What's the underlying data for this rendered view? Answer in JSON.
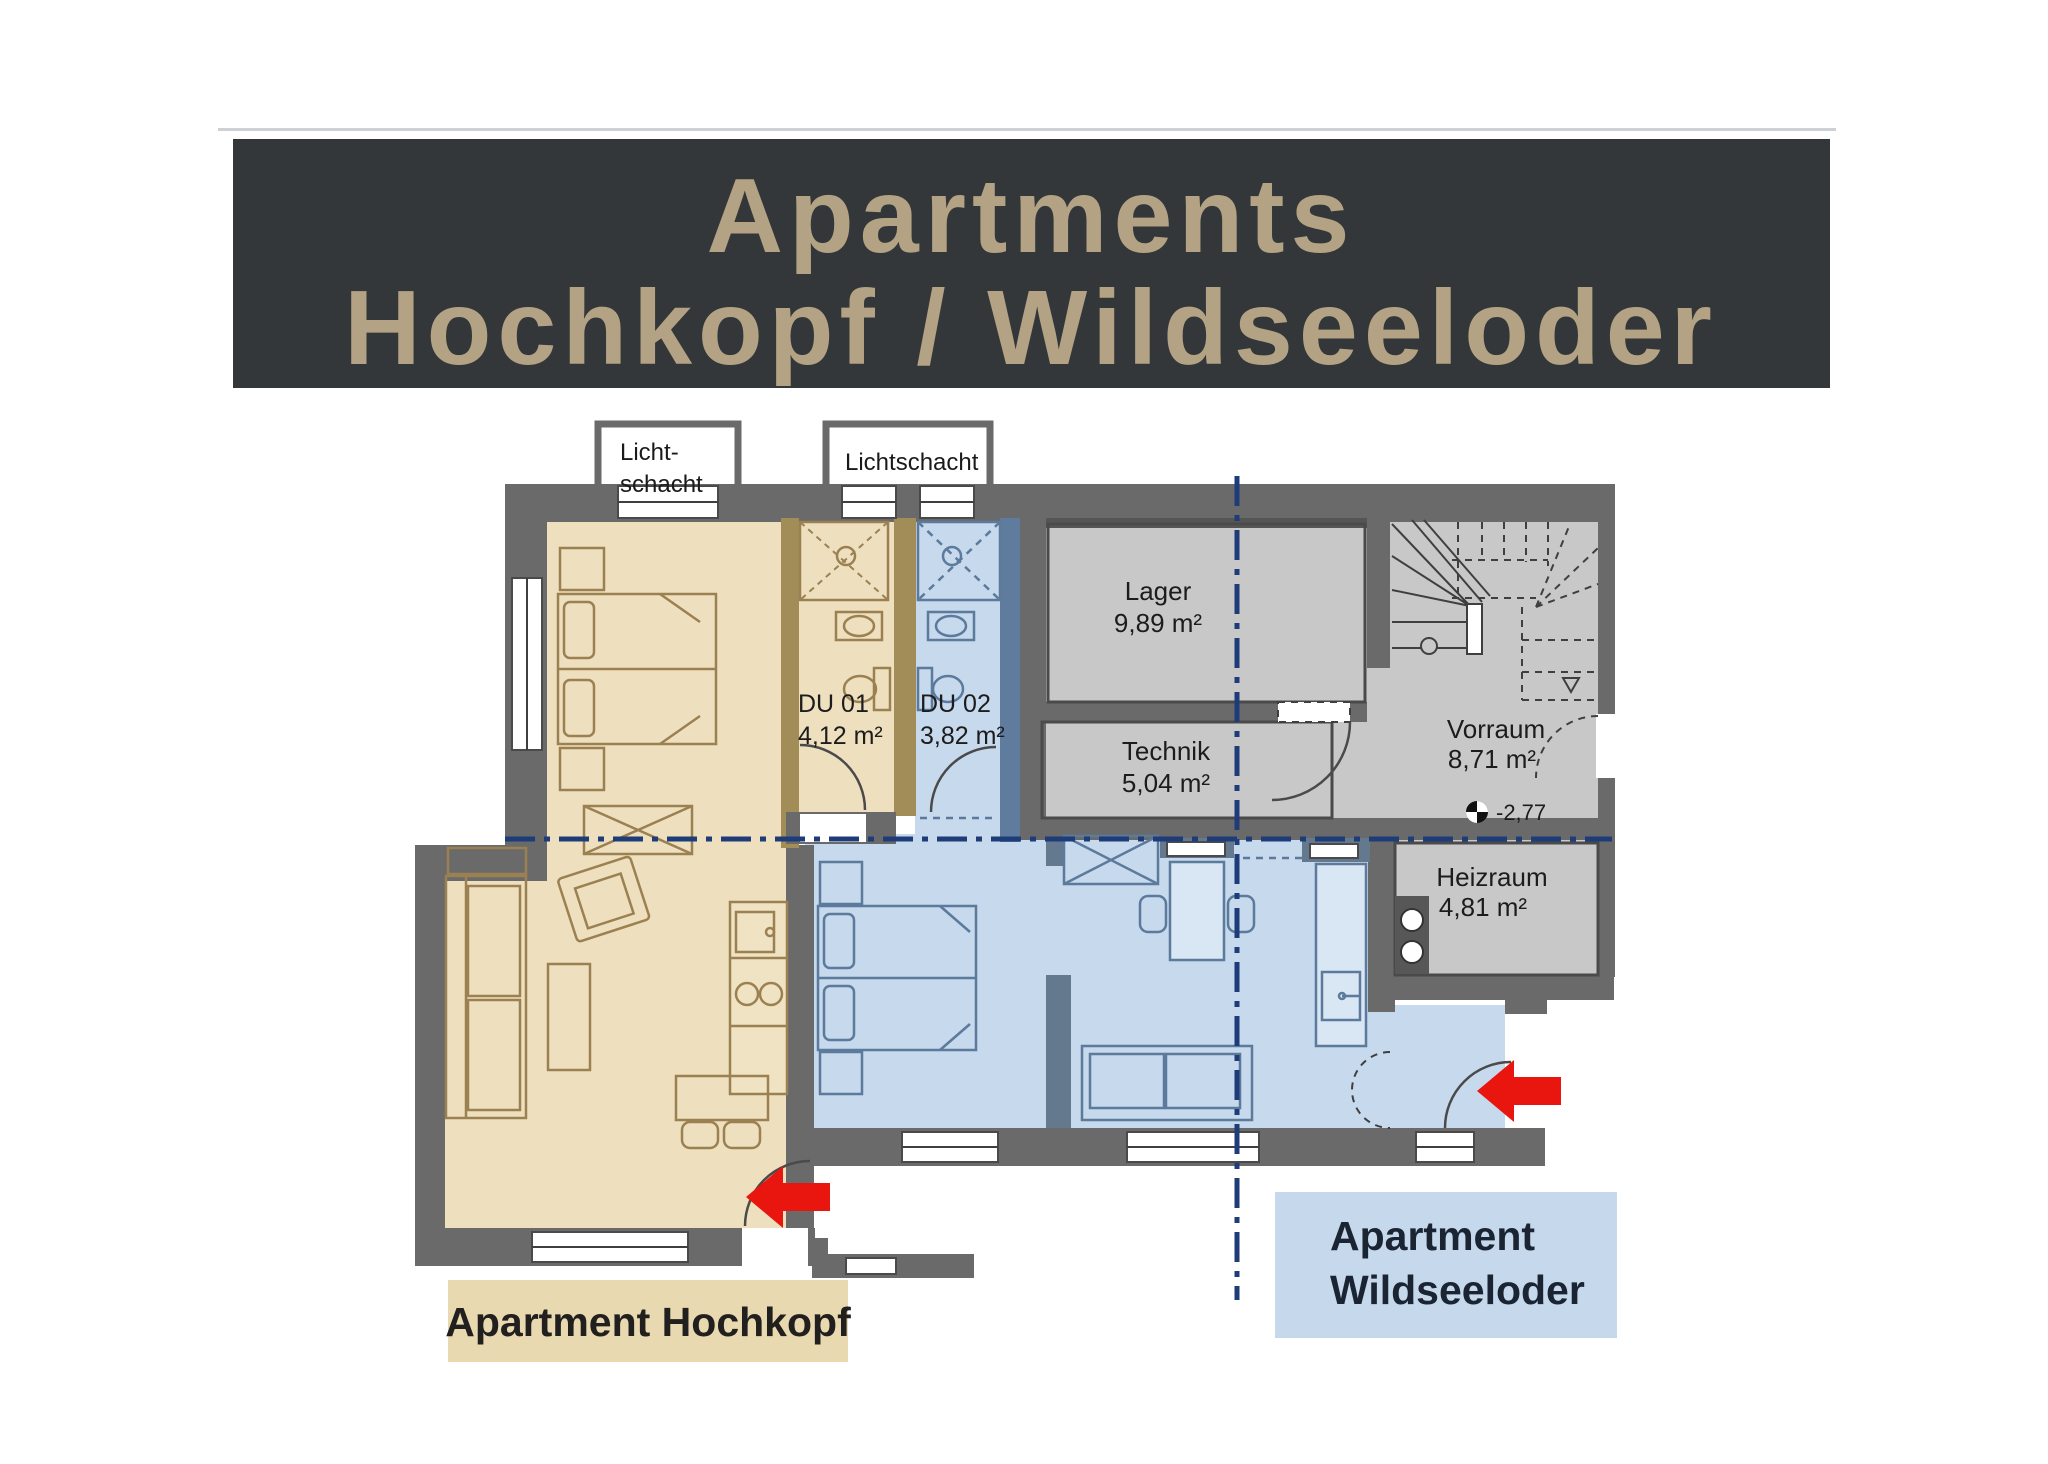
{
  "header": {
    "line1": "Apartments",
    "line2": "Hochkopf / Wildseeloder"
  },
  "plan": {
    "lightshaft_left": {
      "line1": "Licht-",
      "line2": "schacht"
    },
    "lightshaft_right": {
      "label": "Lichtschacht"
    },
    "rooms": {
      "lager": {
        "name": "Lager",
        "area": "9,89 m²"
      },
      "technik": {
        "name": "Technik",
        "area": "5,04 m²"
      },
      "vorraum": {
        "name": "Vorraum",
        "area": "8,71 m²",
        "level": "-2,77"
      },
      "heizraum": {
        "name": "Heizraum",
        "area": "4,81 m²"
      },
      "du01": {
        "name": "DU 01",
        "area": "4,12 m²"
      },
      "du02": {
        "name": "DU 02",
        "area": "3,82 m²"
      }
    },
    "apartments": {
      "hochkopf": {
        "label": "Apartment Hochkopf"
      },
      "wildseeloder": {
        "label_line1": "Apartment",
        "label_line2": "Wildseeloder"
      }
    }
  },
  "colors": {
    "header_bg": "#33373a",
    "header_text": "#b3a284",
    "apartment_tan_fill": "#eee0bf",
    "apartment_tan_wall": "#a28d58",
    "apartment_blue_fill": "#c7d9ec",
    "apartment_blue_wall": "#5f7b9d",
    "wall_gray": "#6a6a6a",
    "room_gray_fill": "#c8c8c8",
    "section_line": "#1e3c78",
    "arrow_red": "#e9150f",
    "label_tan_bg": "#e9d9b1",
    "label_blue_bg": "#c5d8ec"
  }
}
